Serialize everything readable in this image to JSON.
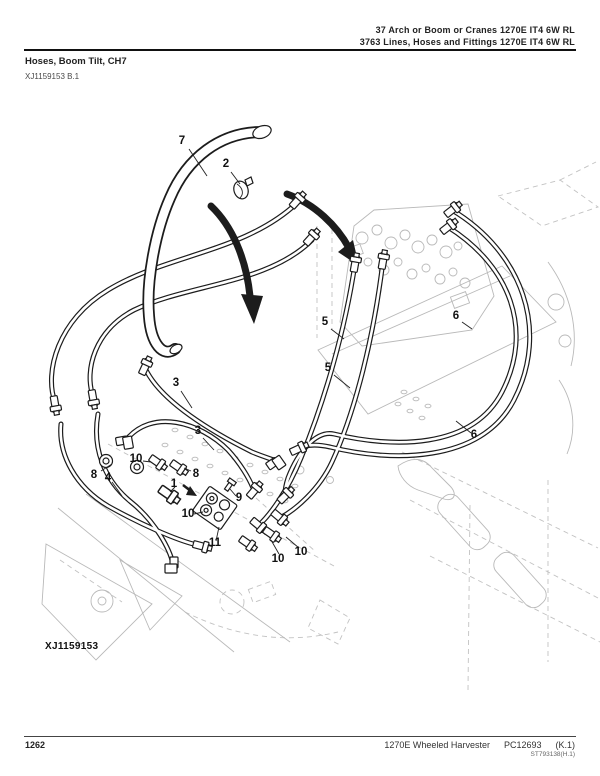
{
  "header": {
    "chapter_line": "37 Arch or Boom or Cranes 1270E IT4 6W RL",
    "section_line": "3763 Lines, Hoses and Fittings 1270E IT4 6W RL",
    "title": "Hoses, Boom Tilt, CH7",
    "figure_ref": "XJ1159153 B.1"
  },
  "diagram": {
    "figure_label": "XJ1159153",
    "callouts": [
      {
        "n": "7"
      },
      {
        "n": "2"
      },
      {
        "n": "5"
      },
      {
        "n": "5"
      },
      {
        "n": "6"
      },
      {
        "n": "6"
      },
      {
        "n": "3"
      },
      {
        "n": "3"
      },
      {
        "n": "10"
      },
      {
        "n": "8"
      },
      {
        "n": "4"
      },
      {
        "n": "8"
      },
      {
        "n": "1"
      },
      {
        "n": "9"
      },
      {
        "n": "10"
      },
      {
        "n": "11"
      },
      {
        "n": "10"
      },
      {
        "n": "10"
      }
    ]
  },
  "footer": {
    "page_number": "1262",
    "model": "1270E Wheeled Harvester",
    "catalog_number": "PC12693",
    "revision": "(K.1)",
    "doc_code": "ST793138(H.1)"
  },
  "colors": {
    "ink": "#1c1c1c",
    "ghost": "#b9b9b9",
    "background": "#ffffff"
  }
}
